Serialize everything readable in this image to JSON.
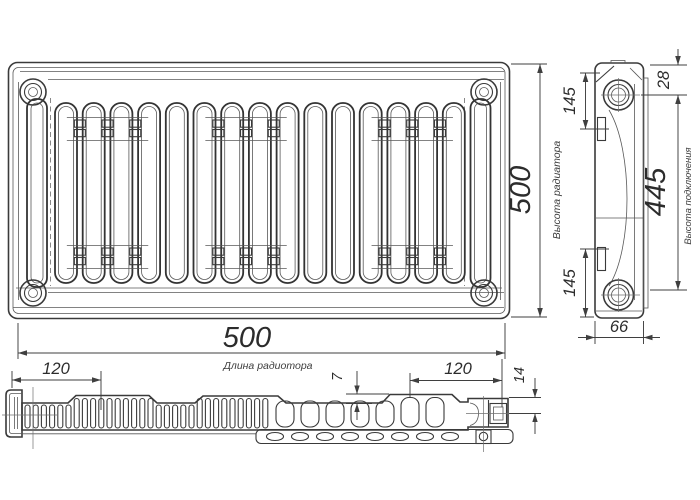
{
  "front": {
    "height_value": "500",
    "height_caption": "Высота радиатора",
    "length_value": "500",
    "length_caption": "Длина радиотора"
  },
  "side": {
    "top_offset": "28",
    "top_bracket": "145",
    "bottom_bracket": "145",
    "connection_height": "445",
    "connection_caption": "Высота подключения",
    "depth": "66"
  },
  "bottom": {
    "left_offset": "120",
    "fin_step": "7",
    "right_offset": "120",
    "port_offset": "14"
  },
  "colors": {
    "line": "#3a3a3a",
    "dimension": "#3f3f3f",
    "background": "#ffffff"
  }
}
